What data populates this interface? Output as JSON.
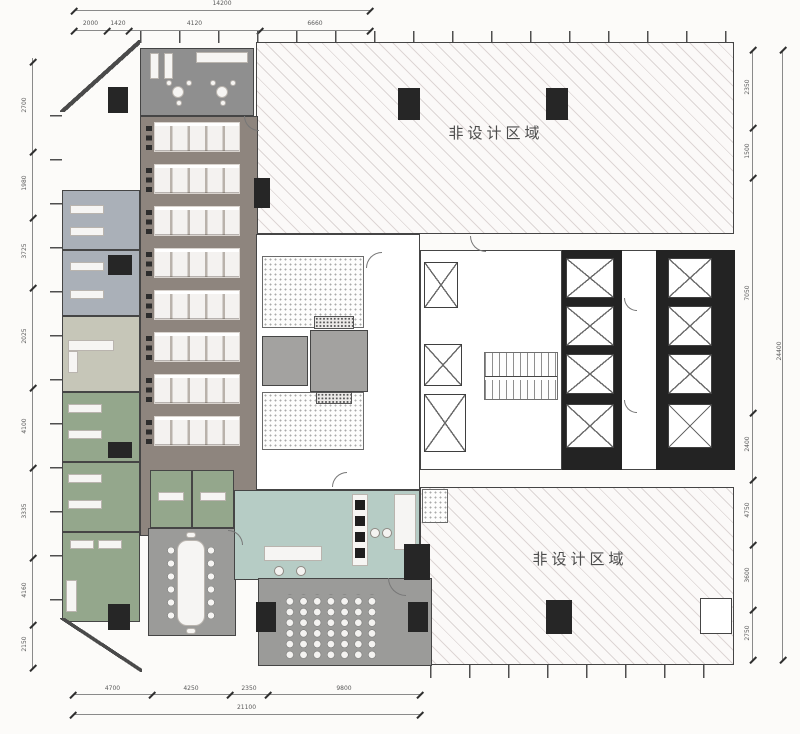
{
  "plan": {
    "non_design_area_label": "非设计区域"
  },
  "dims": {
    "top": {
      "total": "14200",
      "segs": [
        "2000",
        "1420",
        "4120",
        "6660"
      ]
    },
    "bottom": {
      "total": "21100",
      "segs": [
        "4700",
        "4250",
        "2350",
        "9800"
      ]
    },
    "left": {
      "segs": [
        "2700",
        "1980",
        "3725",
        "2025",
        "4100",
        "3335",
        "4160",
        "2150"
      ]
    },
    "right": {
      "total": "24400",
      "segs": [
        "2350",
        "1500",
        "7050",
        "2400",
        "4750",
        "3600",
        "2750"
      ]
    }
  },
  "colors": {
    "wall": "#3c3c3c",
    "open_office_floor": "#8e857e",
    "reception_floor": "#8f8f8f",
    "meeting_floor": "#9b9b99",
    "office_bluegray": "#aab0b8",
    "office_pale": "#c6c6b8",
    "office_green": "#94a78c",
    "pantry_teal": "#b6ccc5",
    "column": "#262626"
  }
}
